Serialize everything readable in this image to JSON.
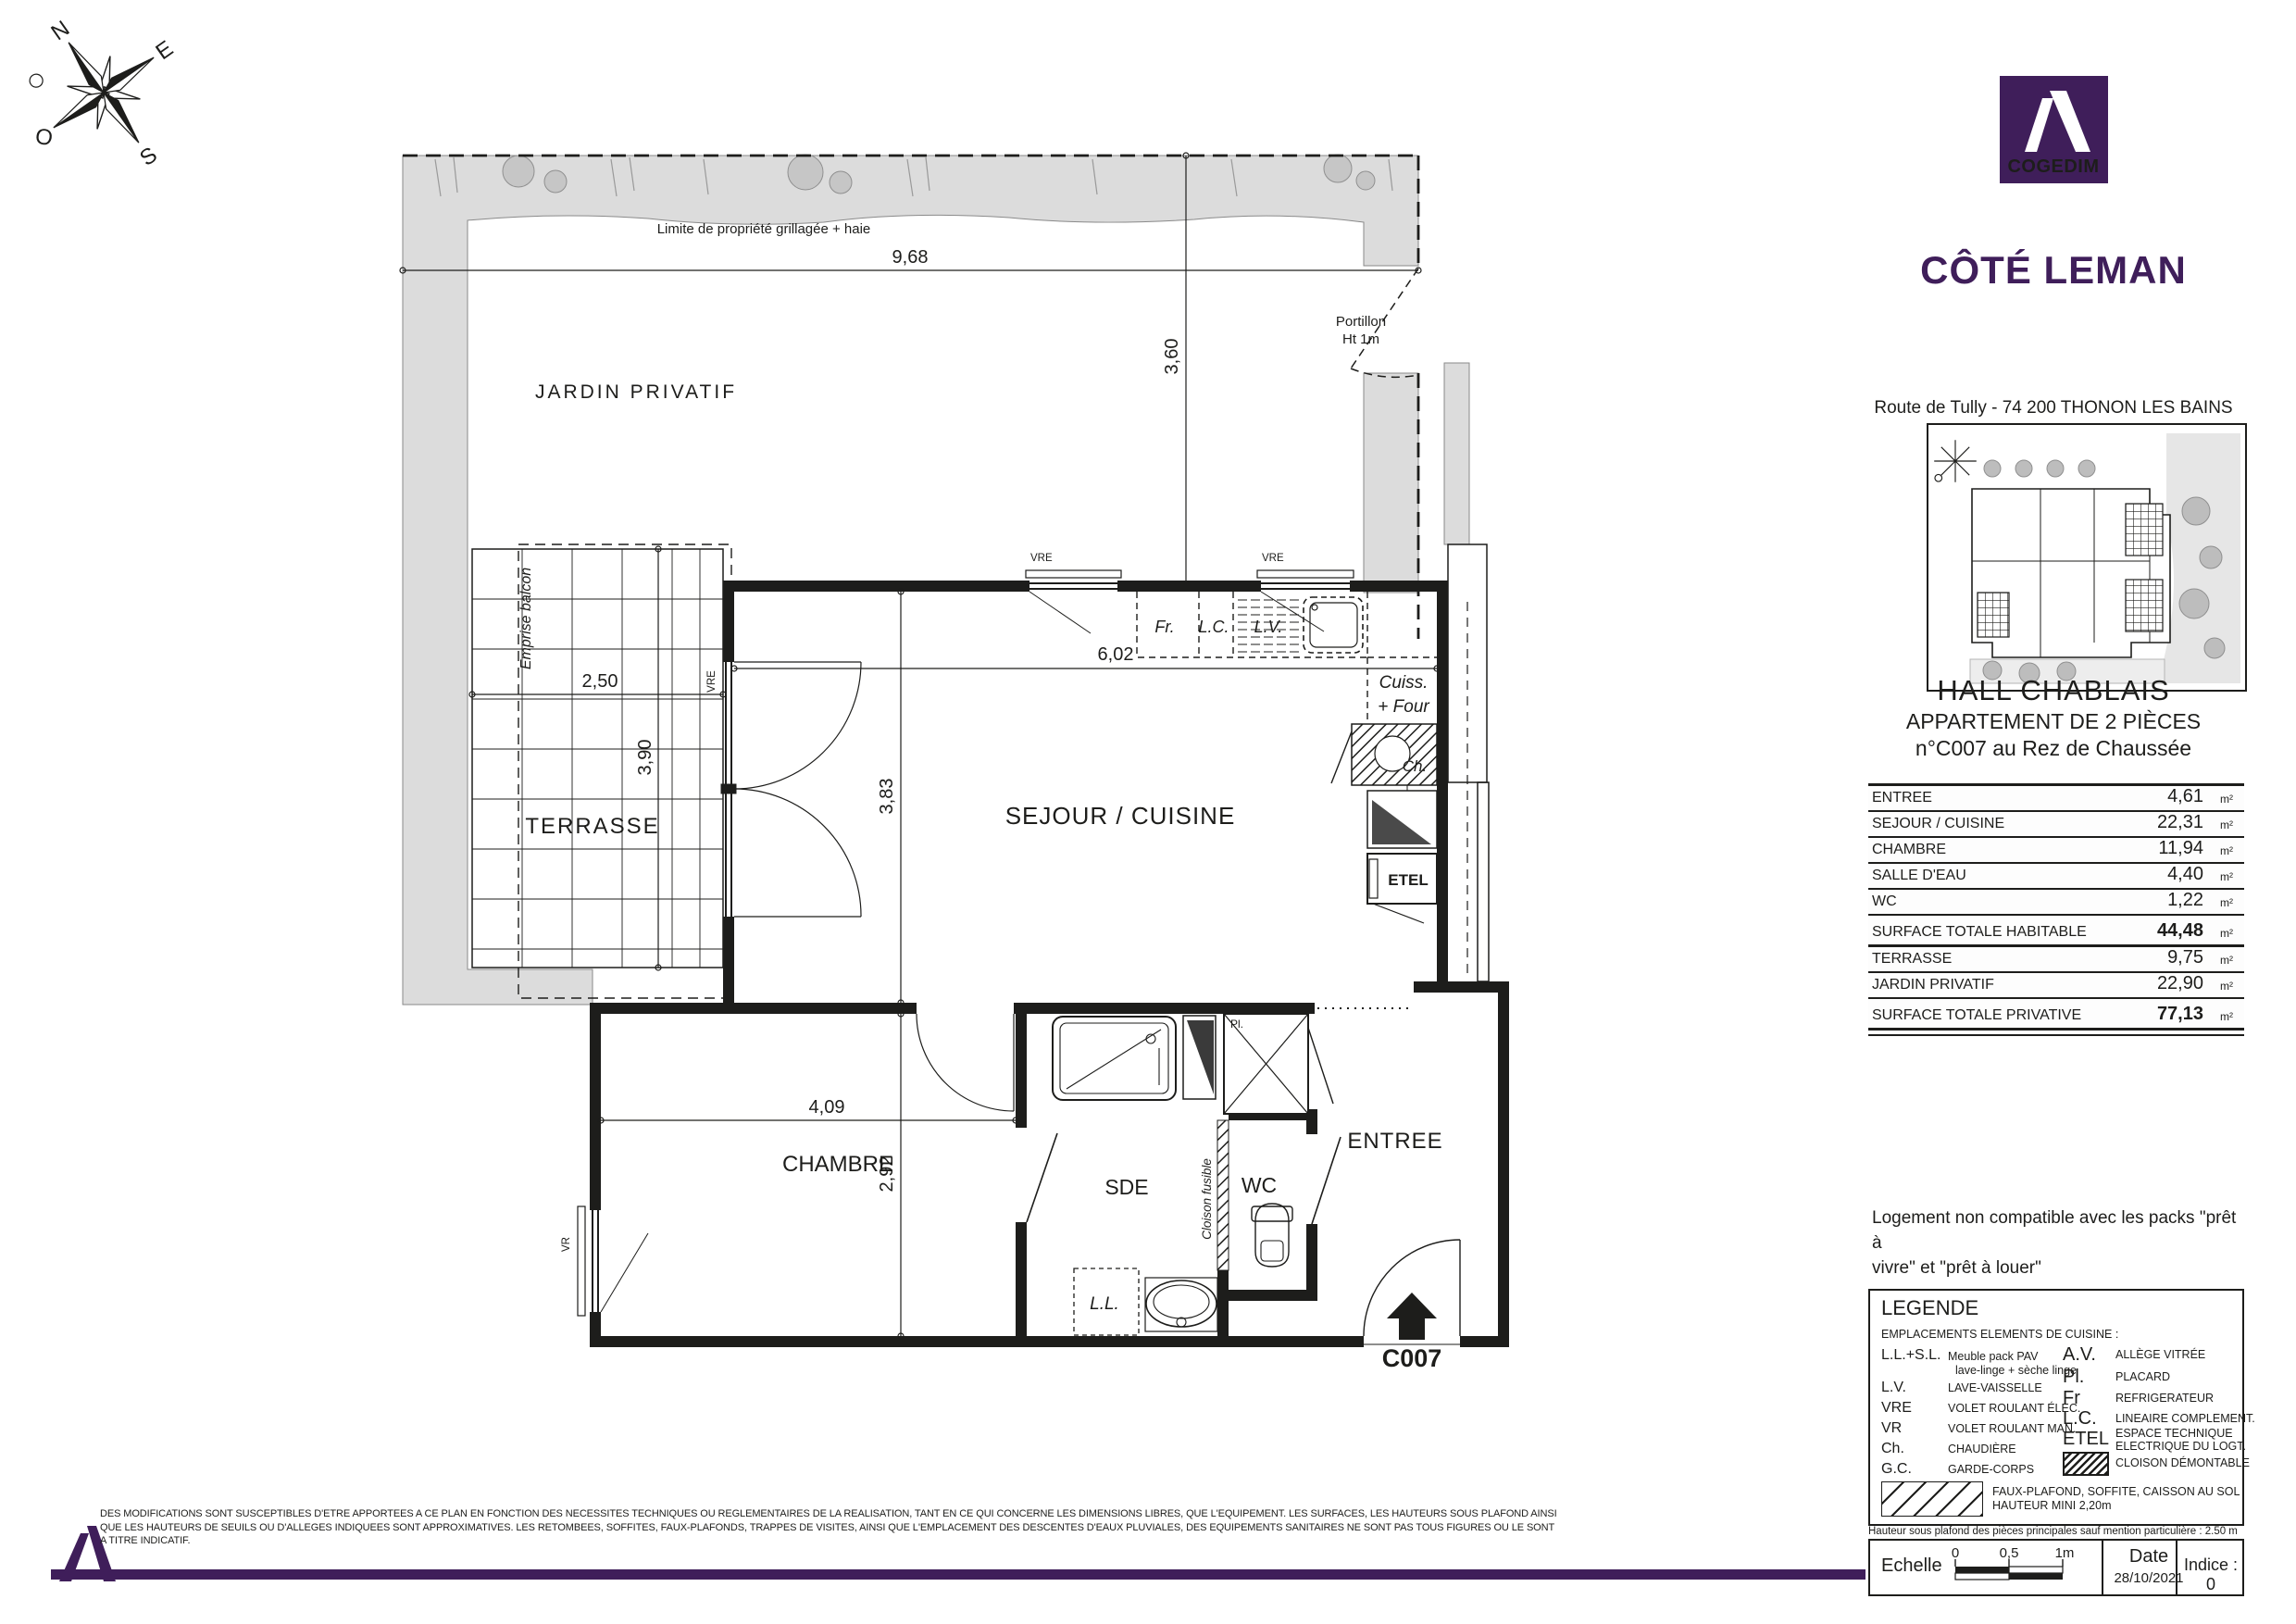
{
  "brand": {
    "logo_text": "COGEDIM",
    "program": "CÔTÉ LEMAN",
    "address": "Route de Tully - 74 200 THONON LES BAINS",
    "purple": "#3F1E5A"
  },
  "compass": {
    "n": "N",
    "e": "E",
    "s": "S",
    "o": "O"
  },
  "plan": {
    "boundary_label": "Limite de propriété grillagée + haie",
    "garden": "JARDIN PRIVATIF",
    "terrace": "TERRASSE",
    "balcony": "Emprise balcon",
    "living": "SEJOUR / CUISINE",
    "bedroom": "CHAMBRE",
    "shower_room": "SDE",
    "wc": "WC",
    "entry": "ENTREE",
    "gate_l1": "Portillon",
    "gate_l2": "Ht 1m",
    "fusible": "Cloison fusible",
    "unit_code": "C007",
    "labels": {
      "vre": "VRE",
      "vr": "VR",
      "fr": "Fr.",
      "lc": "L.C.",
      "lv": "L.V.",
      "cuiss_l1": "Cuiss.",
      "cuiss_l2": "+ Four",
      "ch": "Ch.",
      "etel": "ETEL",
      "ll": "L.L.",
      "pl": "Pl."
    },
    "dims": {
      "d968": "9,68",
      "d360": "3,60",
      "d250": "2,50",
      "d390": "3,90",
      "d602": "6,02",
      "d383": "3,83",
      "d409": "4,09",
      "d292": "2,92"
    }
  },
  "sidebar": {
    "hall": "HALL CHABLAIS",
    "apt_type": "APPARTEMENT DE 2 PIÈCES",
    "apt_num": "n°C007 au Rez de Chaussée",
    "surfaces": {
      "unit": "m²",
      "rows": [
        {
          "label": "ENTREE",
          "value": "4,61"
        },
        {
          "label": "SEJOUR / CUISINE",
          "value": "22,31"
        },
        {
          "label": "CHAMBRE",
          "value": "11,94"
        },
        {
          "label": "SALLE D'EAU",
          "value": "4,40"
        },
        {
          "label": "WC",
          "value": "1,22"
        },
        {
          "label": "SURFACE TOTALE HABITABLE",
          "value": "44,48"
        },
        {
          "label": "TERRASSE",
          "value": "9,75"
        },
        {
          "label": "JARDIN PRIVATIF",
          "value": "22,90"
        },
        {
          "label": "SURFACE TOTALE PRIVATIVE",
          "value": "77,13"
        }
      ]
    },
    "note_l1": "Logement non compatible avec les packs \"prêt à",
    "note_l2": "vivre\" et \"prêt à louer\"",
    "legend": {
      "title": "LEGENDE",
      "intro": "EMPLACEMENTS ELEMENTS DE CUISINE :",
      "left": [
        {
          "abbr": "L.L.+S.L.",
          "desc": "Meuble pack PAV",
          "desc2": "lave-linge + sèche linge"
        },
        {
          "abbr": "L.V.",
          "desc": "LAVE-VAISSELLE"
        },
        {
          "abbr": "VRE",
          "desc": "VOLET ROULANT ÉLEC."
        },
        {
          "abbr": "VR",
          "desc": "VOLET ROULANT MAN."
        },
        {
          "abbr": "Ch.",
          "desc": "CHAUDIÈRE"
        },
        {
          "abbr": "G.C.",
          "desc": "GARDE-CORPS"
        }
      ],
      "right": [
        {
          "abbr": "A.V.",
          "desc": "ALLÈGE VITRÉE"
        },
        {
          "abbr": "Pl.",
          "desc": "PLACARD"
        },
        {
          "abbr": "Fr",
          "desc": "REFRIGERATEUR"
        },
        {
          "abbr": "L.C.",
          "desc": "LINEAIRE COMPLEMENT."
        },
        {
          "abbr": "ETEL",
          "desc": "ESPACE TECHNIQUE",
          "desc2": "ELECTRIQUE DU LOGT."
        },
        {
          "abbr": "",
          "desc": "CLOISON DÉMONTABLE"
        }
      ],
      "bottom": {
        "desc": "FAUX-PLAFOND, SOFFITE, CAISSON AU SOL",
        "desc2": "HAUTEUR MINI 2,20m"
      }
    },
    "ceiling_note": "Hauteur sous plafond des pièces principales sauf mention particulière : 2.50 m",
    "scale": {
      "label": "Echelle",
      "t0": "0",
      "t05": "0,5",
      "t1": "1m",
      "date_label": "Date",
      "date": "28/10/2021",
      "indice": "Indice : 0"
    }
  },
  "footer": {
    "l1": "DES MODIFICATIONS SONT SUSCEPTIBLES D'ETRE APPORTEES A CE PLAN EN FONCTION DES NECESSITES TECHNIQUES OU REGLEMENTAIRES DE LA REALISATION, TANT EN CE QUI CONCERNE LES DIMENSIONS LIBRES, QUE L'EQUIPEMENT. LES SURFACES, LES HAUTEURS SOUS PLAFOND AINSI",
    "l2": "QUE LES HAUTEURS DE SEUILS OU D'ALLEGES INDIQUEES SONT APPROXIMATIVES. LES RETOMBEES, SOFFITES, FAUX-PLAFONDS, TRAPPES DE VISITES, AINSI QUE L'EMPLACEMENT DES DESCENTES D'EAUX PLUVIALES, DES EQUIPEMENTS SANITAIRES NE SONT PAS TOUS FIGURES OU LE SONT",
    "l3": "A TITRE INDICATIF."
  }
}
